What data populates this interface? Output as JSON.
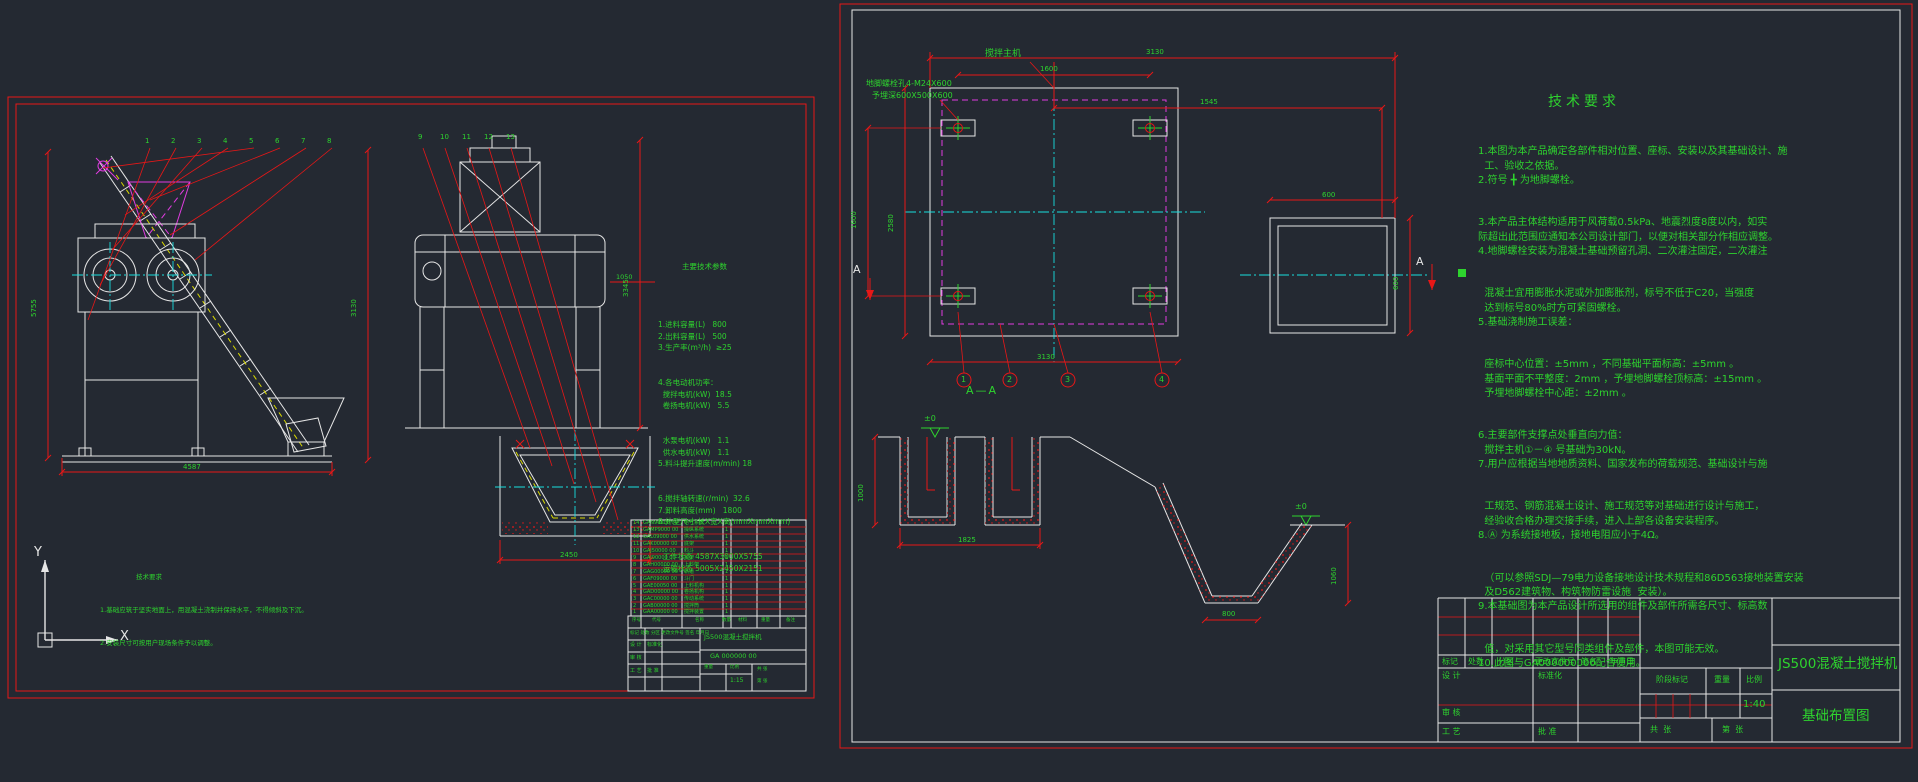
{
  "colors": {
    "bg": "#242932",
    "red": "#e81717",
    "green": "#2ed32e",
    "white": "#e6e6e6",
    "cyan": "#19dede",
    "magenta": "#e03ce0",
    "yellow": "#d8d800"
  },
  "ucs": {
    "y": "Y",
    "x": "X"
  },
  "left": {
    "params_title": "主要技术参数",
    "params": [
      "1.进料容量(L)   800",
      "2.出料容量(L)   500",
      "3.生产率(m³/h)  ≥25",
      "4.各电动机功率：",
      "  搅拌电机(kW)  18.5",
      "  卷扬电机(kW)   5.5",
      "  水泵电机(kW)   1.1",
      "  供水电机(kW)   1.1",
      "5.料斗提升速度(m/min) 18",
      "6.搅拌轴转速(r/min)  32.6",
      "7.卸料高度(mm)   1800",
      "8.外型尺寸 长X宽X高(mmXmmXmm)",
      "  工作状态 4587X3000X5755",
      "  运输状态 5005X2450X2151"
    ],
    "notes_title": "技术要求",
    "notes": [
      "1.基础应筑于坚实地面上，用混凝土浇制并保持水平，不得倾斜及下沉。",
      "2.安装尺寸可按用户现场条件予以调整。"
    ],
    "callouts": [
      "1",
      "2",
      "3",
      "4",
      "5",
      "6",
      "7",
      "8",
      "9",
      "10",
      "11",
      "12",
      "13"
    ],
    "dims": {
      "height": "5755",
      "width": "4587",
      "mid": "3130",
      "v2h": "3345",
      "pit": "2450",
      "small": "1050"
    },
    "bom_headers": [
      "序号",
      "代号",
      "名称",
      "数量",
      "材料",
      "重量",
      "备注"
    ],
    "bom": [
      {
        "no": "14",
        "code": "GAN90000 00",
        "name": "电气系统",
        "qty": "1"
      },
      {
        "no": "13",
        "code": "GAMP9000 00",
        "name": "操纵系统",
        "qty": "1"
      },
      {
        "no": "12",
        "code": "GAL09000 00",
        "name": "供水系统",
        "qty": "1"
      },
      {
        "no": "11",
        "code": "GAK00000 00",
        "name": "底架",
        "qty": "1"
      },
      {
        "no": "10",
        "code": "GAJ50000 00",
        "name": "料斗",
        "qty": "1"
      },
      {
        "no": "9",
        "code": "GAI90000 00",
        "name": "机架",
        "qty": "1"
      },
      {
        "no": "8",
        "code": "GAH00000 00",
        "name": "上料架",
        "qty": "1"
      },
      {
        "no": "7",
        "code": "GAG00000 00",
        "name": "轨道",
        "qty": "1"
      },
      {
        "no": "6",
        "code": "GAF09000 00",
        "name": "斗门",
        "qty": "1"
      },
      {
        "no": "5",
        "code": "GAE00050 00",
        "name": "上料机构",
        "qty": "1"
      },
      {
        "no": "4",
        "code": "GAD00000 00",
        "name": "卷扬机构",
        "qty": "1"
      },
      {
        "no": "3",
        "code": "GAC00000 00",
        "name": "传动系统",
        "qty": "1"
      },
      {
        "no": "2",
        "code": "GAB00000 00",
        "name": "搅拌筒",
        "qty": "1"
      },
      {
        "no": "1",
        "code": "GAA00000 00",
        "name": "搅拌装置",
        "qty": "1"
      }
    ],
    "tb": {
      "row1": "标记 处数 分区 更改文件号 签名 年月日",
      "design": "设 计",
      "std": "标准化",
      "audit": "审 核",
      "craft": "工 艺",
      "approve": "批 准",
      "product": "JS500混凝土搅拌机",
      "dwg_no": "GA 000000 00",
      "weight": "重量",
      "scale_lbl": "比例",
      "scale": "1:15",
      "sheet1": "共 张",
      "sheet2": "第 张"
    }
  },
  "right": {
    "plan": {
      "machine": "搅拌主机",
      "bolt1": "地脚螺栓孔4-M24X600",
      "bolt2": "予埋深600X500X600",
      "a": "A",
      "callouts": [
        "1",
        "2",
        "3",
        "4"
      ],
      "dims": {
        "top": "3130",
        "top2": "1545",
        "pads_h": "1600",
        "pads_v": "1600",
        "left": "2580",
        "bottom": "3130",
        "pad_w": "600",
        "pad_h": "600"
      }
    },
    "section": {
      "title": "A—A",
      "elev": "±0",
      "dims": {
        "depth1": "1000",
        "width1": "1825",
        "depth2": "1060",
        "bottom": "800"
      }
    },
    "tech_title": "技术要求",
    "tech": [
      "1.本图为本产品确定各部件相对位置、座标、安装以及其基础设计、施",
      "  工、验收之依据。",
      "2.符号 ╋ 为地脚螺栓。",
      "3.本产品主体结构适用于风荷载0.5kPa、地震烈度8度以内，如实",
      "际超出此范围应通知本公司设计部门，以便对相关部分作相应调整。",
      "4.地脚螺栓安装为混凝土基础预留孔洞、二次灌注固定，二次灌注",
      "  混凝土宜用膨胀水泥或外加膨胀剂，标号不低于C20，当强度",
      "  达到标号80%时方可紧固螺栓。",
      "5.基础浇制施工误差：",
      "  座标中心位置：±5mm ，不同基础平面标高：±5mm 。",
      "  基面平面不平整度：2mm ，予埋地脚螺栓顶标高：±15mm 。",
      "  予埋地脚螺栓中心距：±2mm 。",
      "6.主要部件支撑点处垂直向力值：",
      "  搅拌主机①－④ 号基础为30kN。",
      "7.用户应根据当地地质资料、国家发布的荷载规范、基础设计与施",
      "  工规范、钢筋混凝土设计、施工规范等对基础进行设计与施工，",
      "  经验收合格办理交接手续，进入上部各设备安装程序。",
      "8.Ⓐ 为系统接地板，接地电阻应小于4Ω。",
      "  （可以参照SDJ—79电力设备接地设计技术规程和86D563接地装置安装",
      "  及D562建筑物、构筑物防雷设施  安装）。",
      "9.本基础图为本产品设计所选用的组件及部件所需各尺寸、标高数",
      "  值，对采用其它型号同类组件及部件，本图可能无效。",
      "10.此图与GA000000000配合使用。"
    ],
    "tb": {
      "mark": "标记",
      "count": "处数",
      "zone": "分区",
      "doc": "更改文件号",
      "sign": "签名",
      "date": "年月日",
      "design": "设 计",
      "std": "标准化",
      "audit": "审 核",
      "craft": "工 艺",
      "approve": "批 准",
      "stage": "阶段标记",
      "weight": "重量",
      "scale_lbl": "比例",
      "scale": "1:40",
      "sheets_total": "共  张",
      "sheet_no": "第  张",
      "product": "JS500混凝土搅拌机",
      "title": "基础布置图"
    }
  }
}
